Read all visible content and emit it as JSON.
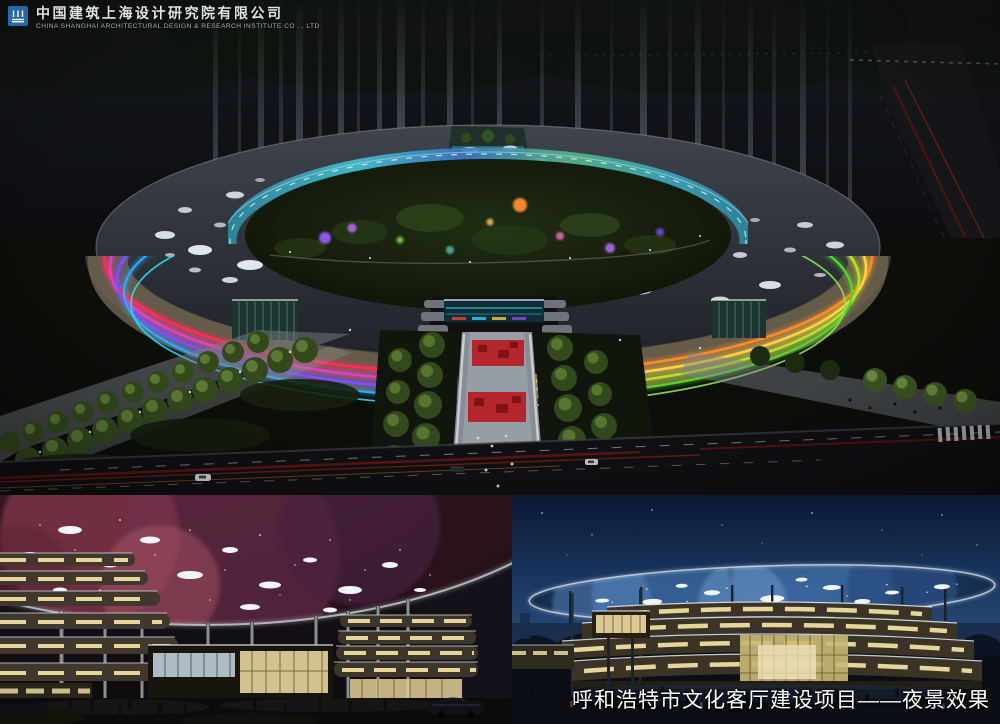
{
  "header": {
    "logo_icon": "csadi-seal-icon",
    "company_name_zh": "中国建筑上海设计研究院有限公司",
    "company_name_en": "CHINA SHANGHAI ARCHITECTURAL DESIGN & RESEARCH INSTITUTE CO . , LTD"
  },
  "caption": {
    "project_title": "呼和浩特市文化客厅建设项目——夜景效果"
  },
  "colors": {
    "logo_blue": "#2468ae",
    "caption_white": "#ffffff",
    "sky_dark": "#0b0d11",
    "night_blue_sky": "#16335e",
    "roof_slate": "#31353c",
    "band_red": "#ff2d55",
    "band_magenta": "#e33fc0",
    "band_purple": "#7d4fff",
    "band_blue": "#2fa8ff",
    "band_cyan": "#2fd8e8",
    "band_green": "#5ad42c",
    "band_yellowgreen": "#b8e028",
    "band_yellow": "#ffd23f",
    "band_orange": "#ff8a2a",
    "plaza_red": "#b5262c",
    "tree_green_lit": "#5d7f32",
    "warm_window": "#f0dfa2",
    "nebula_pink": "#8a3a50",
    "galaxy_blue": "#3f6ea8"
  }
}
